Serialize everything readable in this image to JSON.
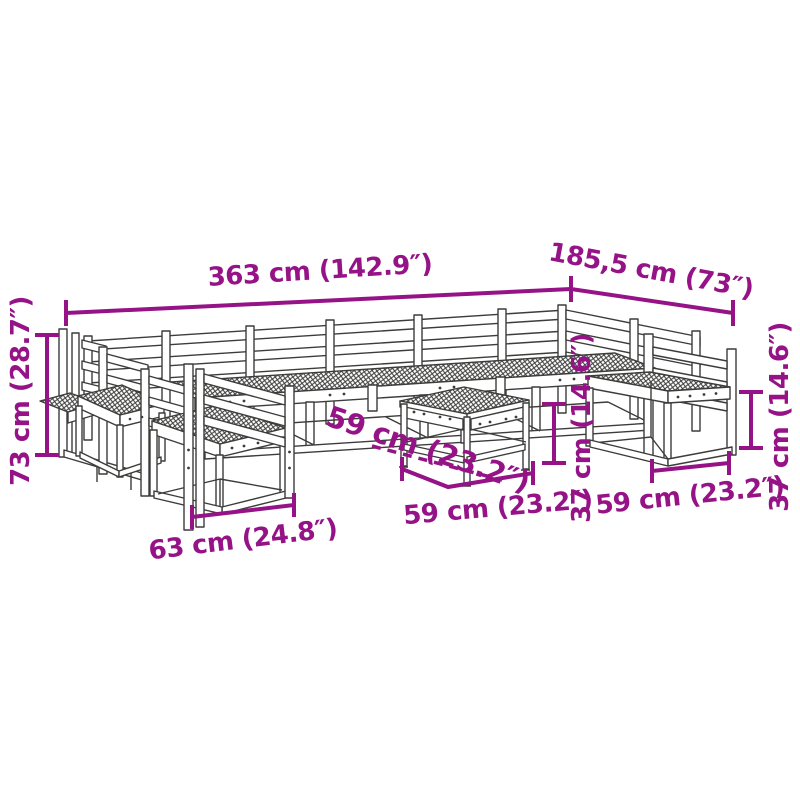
{
  "diagram": {
    "type": "product-dimension-line-drawing",
    "subject": "modular garden lounge set with coffee table (isometric wireframe)",
    "background_color": "#FFFFFF",
    "line_art_color": "#3C3C3B",
    "dimension_color": "#951387"
  },
  "annotations": {
    "overall_width": {
      "label": "363 cm (142.9″)"
    },
    "overall_depth": {
      "label": "185,5 cm (73″)"
    },
    "overall_height": {
      "label": "73 cm (28.7″)"
    },
    "table_depth": {
      "label": "59 cm (23.2″)"
    },
    "table_height": {
      "label": "37 cm (14.6″)"
    },
    "table_width": {
      "label": "59 cm (23.2″)"
    },
    "right_seat_width": {
      "label": "59 cm (23.2″)"
    },
    "right_seat_height": {
      "label": "37 cm (14.6″)"
    },
    "left_chair_width": {
      "label": "63 cm (24.8″)"
    }
  }
}
